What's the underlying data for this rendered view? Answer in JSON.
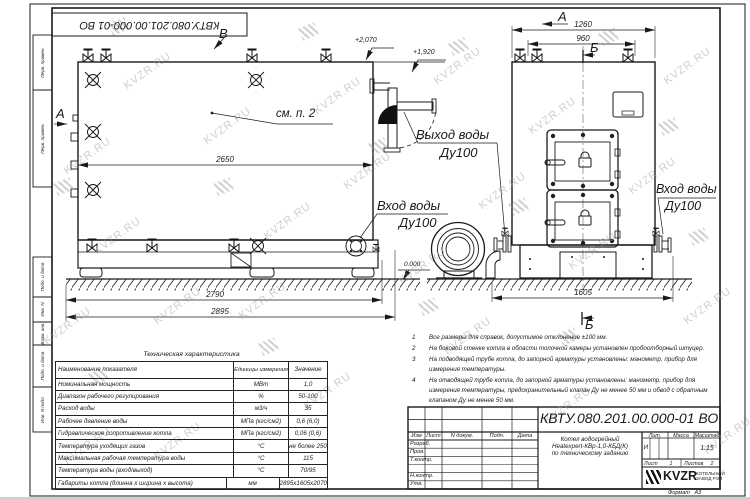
{
  "watermark": {
    "text": "KVZR.RU"
  },
  "margin": {
    "doc_number_top": "КВТУ.080.201.00.000-01 ВО",
    "stamps": [
      "Перв. примен.",
      "Перв. примен.",
      "Подп. и дата",
      "Инв. N дубл.",
      "Взам. инв. N",
      "Подп. и дата",
      "Инв. N подл."
    ]
  },
  "drawing": {
    "view_b": "В",
    "view_a_side": "А",
    "view_a_front": "А",
    "section_b_top": "Б",
    "section_b_bottom": "Б",
    "callout_note": "см. п. 2",
    "labels": {
      "outlet_title": "Выход воды",
      "outlet_dn": "Ду100",
      "inlet_side_title": "Вход воды",
      "inlet_side_dn": "Ду100",
      "inlet_front_title": "Вход воды",
      "inlet_front_dn": "Ду100"
    },
    "dims": {
      "body_length": "2650",
      "base_length": "2790",
      "overall_length": "2895",
      "front_width": "1260",
      "valve_spacing": "960",
      "front_base": "1605",
      "elev_top": "+2,070",
      "elev_outlet": "+1,920",
      "elev_zero": "0.000"
    }
  },
  "notes": {
    "items": [
      {
        "num": "1",
        "text": "Все размеры для справок, допустимое отклонение ±100 мм."
      },
      {
        "num": "2",
        "text": "На боковой стенке котла в области топочной камеры установлен пробоотборный штуцер."
      },
      {
        "num": "3",
        "text": "На подводящей трубе котла, до запорной арматуры установлены: манометр, прибор для измерения температуры."
      },
      {
        "num": "4",
        "text": "На отводящей трубе котла, до запорной арматуры установлены: манометр, прибор для измерения температуры, предохранительный клапан Ду не менее 50 мм и обвод с обратным клапаном Ду не менее 50 мм."
      }
    ]
  },
  "tech_table": {
    "title": "Техническая характеристика",
    "col_name": "Наименование показателя",
    "col_units": "Единицы измерения",
    "col_value": "Значение",
    "rows": [
      {
        "name": "Номинальная мощность",
        "unit": "МВт",
        "value": "1,0"
      },
      {
        "name": "Диапазон рабочего регулирования",
        "unit": "%",
        "value": "50-100"
      },
      {
        "name": "Расход воды",
        "unit": "м3/ч",
        "value": "35"
      },
      {
        "name": "Рабочее давление воды",
        "unit": "МПа (кгс/см2)",
        "value": "0,6 (6,0)"
      },
      {
        "name": "Гидравлическое сопротивление котла",
        "unit": "МПа (кгс/см2)",
        "value": "0,06 (0,6)"
      },
      {
        "name": "Температура уходящих газов",
        "unit": "°С",
        "value": "не более 250"
      },
      {
        "name": "Максимальная рабочая температура воды",
        "unit": "°С",
        "value": "115"
      },
      {
        "name": "Температура воды (вход/выход)",
        "unit": "°С",
        "value": "70/95"
      },
      {
        "name": "Габариты котла (длинна х ширина х высота)",
        "unit": "мм",
        "value": "2895х1605х2070"
      }
    ]
  },
  "title_block": {
    "doc_number": "КВТУ.080.201.00.000-01 ВО",
    "rev_headers": {
      "izm": "Изм",
      "list": "Лист",
      "ndoc": "N докум.",
      "podp": "Подп.",
      "data": "Дата"
    },
    "sign_rows": {
      "r0": "Разраб.",
      "r1": "Пров.",
      "r2": "Т.контр.",
      "r3": "Н.контр.",
      "r4": "Утв."
    },
    "product": {
      "line1": "Котел водогрейный",
      "line2": "Heatexpert-КВр-1,0-КБД(К)",
      "line3": "по техническому заданию"
    },
    "lit": {
      "header_lit": "Лит.",
      "header_mass": "Масса",
      "header_scale": "Масштаб",
      "lit_value": "И",
      "scale_value": "1:15"
    },
    "sheets": {
      "sheet_label": "Лист",
      "sheet_value": "1",
      "sheets_label": "Листов",
      "sheets_value": "2"
    },
    "company": {
      "logo": "KVZR",
      "name1": "КОТЕЛЬНЫЙ",
      "name2": "ЗАВОД РЭП"
    },
    "format": {
      "label": "Формат",
      "value": "А3"
    }
  }
}
